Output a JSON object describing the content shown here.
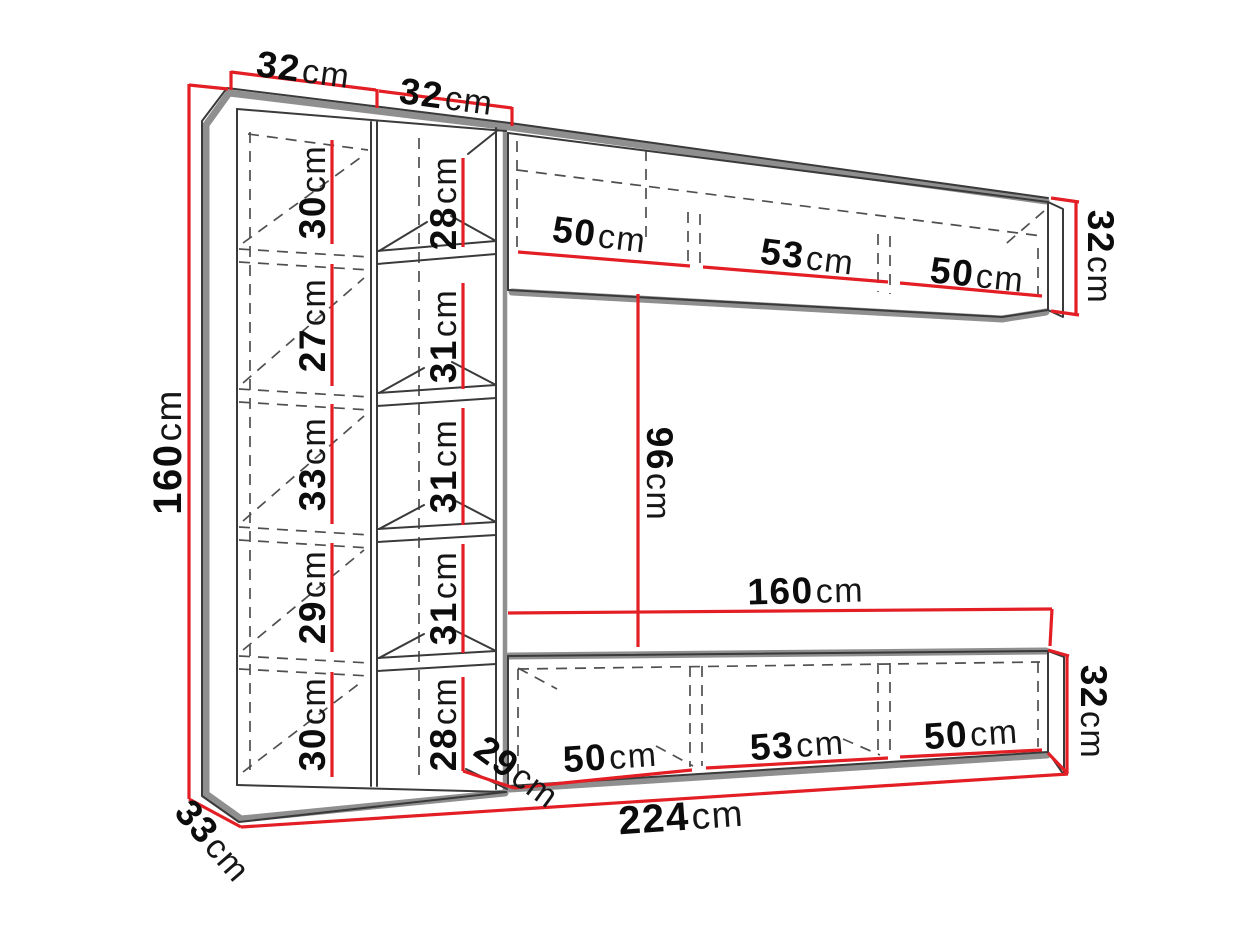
{
  "diagram": {
    "type": "furniture-dimension-diagram",
    "subject": "wall-unit-with-bookcase-columns-and-two-floating-cabinets",
    "background": "#ffffff",
    "colors": {
      "dimension_red": "#e31e24",
      "outline_gray": "#8f8f8f",
      "line_dark": "#3a3a3a",
      "dash_gray": "#4f4f4f",
      "text_dark": "#0c0c0c"
    },
    "dimensions": {
      "col_a_width": {
        "value": "32",
        "unit": "cm"
      },
      "col_b_width": {
        "value": "32",
        "unit": "cm"
      },
      "total_height": {
        "value": "160",
        "unit": "cm"
      },
      "col_a_sections": [
        {
          "value": "30",
          "unit": "cm"
        },
        {
          "value": "27",
          "unit": "cm"
        },
        {
          "value": "33",
          "unit": "cm"
        },
        {
          "value": "29",
          "unit": "cm"
        },
        {
          "value": "30",
          "unit": "cm"
        }
      ],
      "col_b_sections": [
        {
          "value": "28",
          "unit": "cm"
        },
        {
          "value": "31",
          "unit": "cm"
        },
        {
          "value": "31",
          "unit": "cm"
        },
        {
          "value": "31",
          "unit": "cm"
        },
        {
          "value": "28",
          "unit": "cm"
        }
      ],
      "top_cabinet": {
        "sections": [
          {
            "value": "50",
            "unit": "cm"
          },
          {
            "value": "53",
            "unit": "cm"
          },
          {
            "value": "50",
            "unit": "cm"
          }
        ],
        "height": {
          "value": "32",
          "unit": "cm"
        }
      },
      "gap_height": {
        "value": "96",
        "unit": "cm"
      },
      "lower_cabinet_width": {
        "value": "160",
        "unit": "cm"
      },
      "bottom_cabinet": {
        "sections": [
          {
            "value": "50",
            "unit": "cm"
          },
          {
            "value": "53",
            "unit": "cm"
          },
          {
            "value": "50",
            "unit": "cm"
          }
        ],
        "height": {
          "value": "32",
          "unit": "cm"
        },
        "depth": {
          "value": "29",
          "unit": "cm"
        }
      },
      "total_width": {
        "value": "224",
        "unit": "cm"
      },
      "side_depth": {
        "value": "33",
        "unit": "cm"
      }
    }
  }
}
